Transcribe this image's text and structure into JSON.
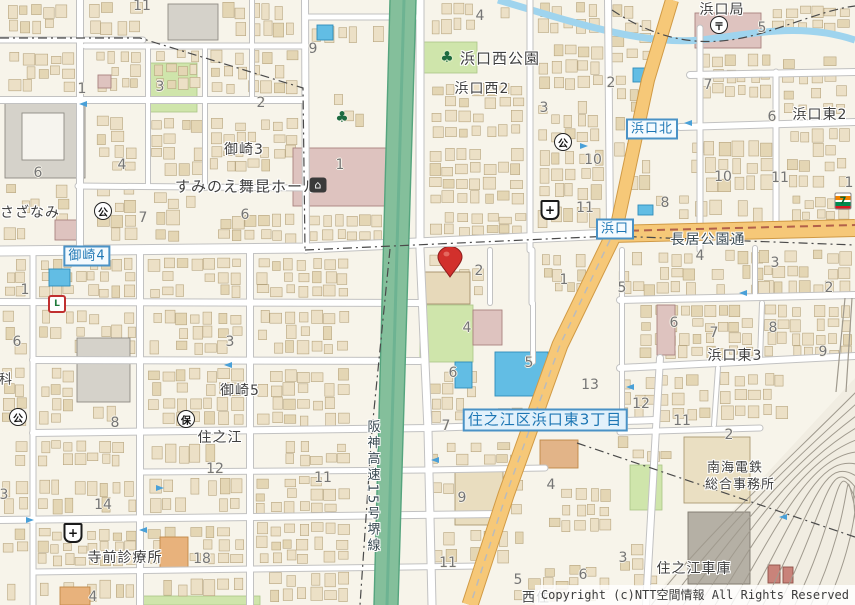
{
  "attribution": {
    "copyright": "Copyright (c)NTT空間情報 All Rights Reserved"
  },
  "map": {
    "place_labels": [
      {
        "text": "浜口西公園",
        "x": 500,
        "y": 58,
        "size": 15
      },
      {
        "text": "浜口西2",
        "x": 482,
        "y": 88,
        "size": 14
      },
      {
        "text": "浜口局",
        "x": 722,
        "y": 9,
        "size": 14
      },
      {
        "text": "浜口東2",
        "x": 820,
        "y": 114,
        "size": 14
      },
      {
        "text": "御崎3",
        "x": 244,
        "y": 149,
        "size": 14
      },
      {
        "text": "すみのえ舞昆ホール",
        "x": 247,
        "y": 186,
        "size": 15
      },
      {
        "text": "さざなみ",
        "x": 30,
        "y": 212,
        "size": 14
      },
      {
        "text": "御崎5",
        "x": 240,
        "y": 390,
        "size": 14
      },
      {
        "text": "住之江",
        "x": 220,
        "y": 437,
        "size": 14
      },
      {
        "text": "浜口東3",
        "x": 735,
        "y": 355,
        "size": 14
      },
      {
        "text": "寺前診療所",
        "x": 125,
        "y": 557,
        "size": 14
      },
      {
        "text": "南海電鉄",
        "x": 735,
        "y": 466,
        "size": 13
      },
      {
        "text": "総合事務所",
        "x": 740,
        "y": 483,
        "size": 13
      },
      {
        "text": "住之江車庫",
        "x": 694,
        "y": 568,
        "size": 14
      },
      {
        "text": "科",
        "x": 6,
        "y": 378,
        "size": 13
      },
      {
        "text": "西住",
        "x": 536,
        "y": 596,
        "size": 13
      }
    ],
    "road_labels": [
      {
        "text": "長居公園通",
        "x": 708,
        "y": 239,
        "size": 14,
        "vertical": false
      },
      {
        "text": "阪神高速15号堺線",
        "x": 372,
        "y": 487,
        "size": 13,
        "vertical": true
      }
    ],
    "area_badges": [
      {
        "text": "浜口北",
        "x": 652,
        "y": 129,
        "big": false
      },
      {
        "text": "浜口",
        "x": 615,
        "y": 229,
        "big": false
      },
      {
        "text": "御崎4",
        "x": 87,
        "y": 256,
        "big": false
      },
      {
        "text": "住之江区浜口東3丁目",
        "x": 545,
        "y": 420,
        "big": true
      }
    ],
    "block_numbers": [
      {
        "n": "11",
        "x": 142,
        "y": 6
      },
      {
        "n": "4",
        "x": 480,
        "y": 16
      },
      {
        "n": "5",
        "x": 762,
        "y": 28
      },
      {
        "n": "9",
        "x": 313,
        "y": 49
      },
      {
        "n": "2",
        "x": 611,
        "y": 83
      },
      {
        "n": "7",
        "x": 708,
        "y": 85
      },
      {
        "n": "1",
        "x": 82,
        "y": 89
      },
      {
        "n": "3",
        "x": 160,
        "y": 87
      },
      {
        "n": "2",
        "x": 261,
        "y": 103
      },
      {
        "n": "3",
        "x": 544,
        "y": 108
      },
      {
        "n": "6",
        "x": 772,
        "y": 117
      },
      {
        "n": "4",
        "x": 122,
        "y": 165
      },
      {
        "n": "6",
        "x": 38,
        "y": 173
      },
      {
        "n": "1",
        "x": 340,
        "y": 165
      },
      {
        "n": "10",
        "x": 593,
        "y": 160
      },
      {
        "n": "10",
        "x": 723,
        "y": 177
      },
      {
        "n": "11",
        "x": 780,
        "y": 178
      },
      {
        "n": "1",
        "x": 849,
        "y": 183
      },
      {
        "n": "8",
        "x": 665,
        "y": 203
      },
      {
        "n": "11",
        "x": 585,
        "y": 208
      },
      {
        "n": "6",
        "x": 245,
        "y": 215
      },
      {
        "n": "7",
        "x": 143,
        "y": 218
      },
      {
        "n": "4",
        "x": 700,
        "y": 256
      },
      {
        "n": "3",
        "x": 775,
        "y": 263
      },
      {
        "n": "2",
        "x": 479,
        "y": 271
      },
      {
        "n": "1",
        "x": 564,
        "y": 280
      },
      {
        "n": "2",
        "x": 829,
        "y": 288
      },
      {
        "n": "5",
        "x": 622,
        "y": 288
      },
      {
        "n": "1",
        "x": 25,
        "y": 290
      },
      {
        "n": "4",
        "x": 467,
        "y": 328
      },
      {
        "n": "6",
        "x": 674,
        "y": 323
      },
      {
        "n": "7",
        "x": 714,
        "y": 333
      },
      {
        "n": "8",
        "x": 773,
        "y": 328
      },
      {
        "n": "6",
        "x": 17,
        "y": 342
      },
      {
        "n": "3",
        "x": 230,
        "y": 342
      },
      {
        "n": "9",
        "x": 823,
        "y": 352
      },
      {
        "n": "5",
        "x": 529,
        "y": 363
      },
      {
        "n": "6",
        "x": 453,
        "y": 373
      },
      {
        "n": "13",
        "x": 590,
        "y": 385
      },
      {
        "n": "12",
        "x": 641,
        "y": 404
      },
      {
        "n": "8",
        "x": 115,
        "y": 423
      },
      {
        "n": "7",
        "x": 446,
        "y": 426
      },
      {
        "n": "11",
        "x": 682,
        "y": 421
      },
      {
        "n": "2",
        "x": 729,
        "y": 435
      },
      {
        "n": "12",
        "x": 215,
        "y": 469
      },
      {
        "n": "11",
        "x": 323,
        "y": 478
      },
      {
        "n": "9",
        "x": 462,
        "y": 498
      },
      {
        "n": "4",
        "x": 551,
        "y": 485
      },
      {
        "n": "14",
        "x": 103,
        "y": 505
      },
      {
        "n": "3",
        "x": 4,
        "y": 495
      },
      {
        "n": "18",
        "x": 202,
        "y": 559
      },
      {
        "n": "3",
        "x": 623,
        "y": 558
      },
      {
        "n": "11",
        "x": 448,
        "y": 563
      },
      {
        "n": "5",
        "x": 518,
        "y": 580
      },
      {
        "n": "6",
        "x": 583,
        "y": 575
      },
      {
        "n": "4",
        "x": 93,
        "y": 597
      }
    ],
    "icons": [
      {
        "type": "park",
        "glyph": "公",
        "x": 563,
        "y": 142
      },
      {
        "type": "park",
        "glyph": "公",
        "x": 103,
        "y": 211
      },
      {
        "type": "park",
        "glyph": "公",
        "x": 18,
        "y": 417
      },
      {
        "type": "hoiku",
        "glyph": "保",
        "x": 186,
        "y": 419
      },
      {
        "type": "post",
        "glyph": "〒",
        "x": 719,
        "y": 25
      },
      {
        "type": "hospital",
        "glyph": "+",
        "x": 550,
        "y": 210
      },
      {
        "type": "hospital",
        "glyph": "+",
        "x": 73,
        "y": 533
      },
      {
        "type": "tree",
        "glyph": "♣",
        "x": 447,
        "y": 57
      },
      {
        "type": "tree",
        "glyph": "♣",
        "x": 342,
        "y": 117
      },
      {
        "type": "hall",
        "glyph": "⌂",
        "x": 318,
        "y": 185
      },
      {
        "type": "seven",
        "glyph": "7",
        "x": 843,
        "y": 201
      },
      {
        "type": "store",
        "glyph": "L",
        "x": 57,
        "y": 304
      }
    ],
    "arrows": [
      {
        "x": 83,
        "y": 104,
        "rot": 180
      },
      {
        "x": 228,
        "y": 365,
        "rot": 180
      },
      {
        "x": 30,
        "y": 520,
        "rot": 0
      },
      {
        "x": 143,
        "y": 530,
        "rot": 180
      },
      {
        "x": 435,
        "y": 460,
        "rot": 180
      },
      {
        "x": 688,
        "y": 123,
        "rot": 180
      },
      {
        "x": 743,
        "y": 293,
        "rot": 180
      },
      {
        "x": 630,
        "y": 387,
        "rot": 180
      },
      {
        "x": 160,
        "y": 488,
        "rot": 0
      },
      {
        "x": 783,
        "y": 517,
        "rot": 180
      },
      {
        "x": 584,
        "y": 146,
        "rot": 0
      }
    ],
    "marker": {
      "x": 450,
      "y": 277,
      "color": "#d2302c"
    },
    "colors": {
      "background": "#f7f4ea",
      "building": "#ece0c6",
      "road": "#ffffff",
      "main_road_orange": "#f6c878",
      "expressway_green": "#84bf9b",
      "park_green": "#cfe5ab",
      "water_blue": "#9fd4ee",
      "pool_blue": "#62bde4",
      "notable_pink": "#dec3bf",
      "notable_gray": "#d5d2ca",
      "badge_blue": "#4a92c6",
      "pin_red": "#d2302c"
    }
  }
}
